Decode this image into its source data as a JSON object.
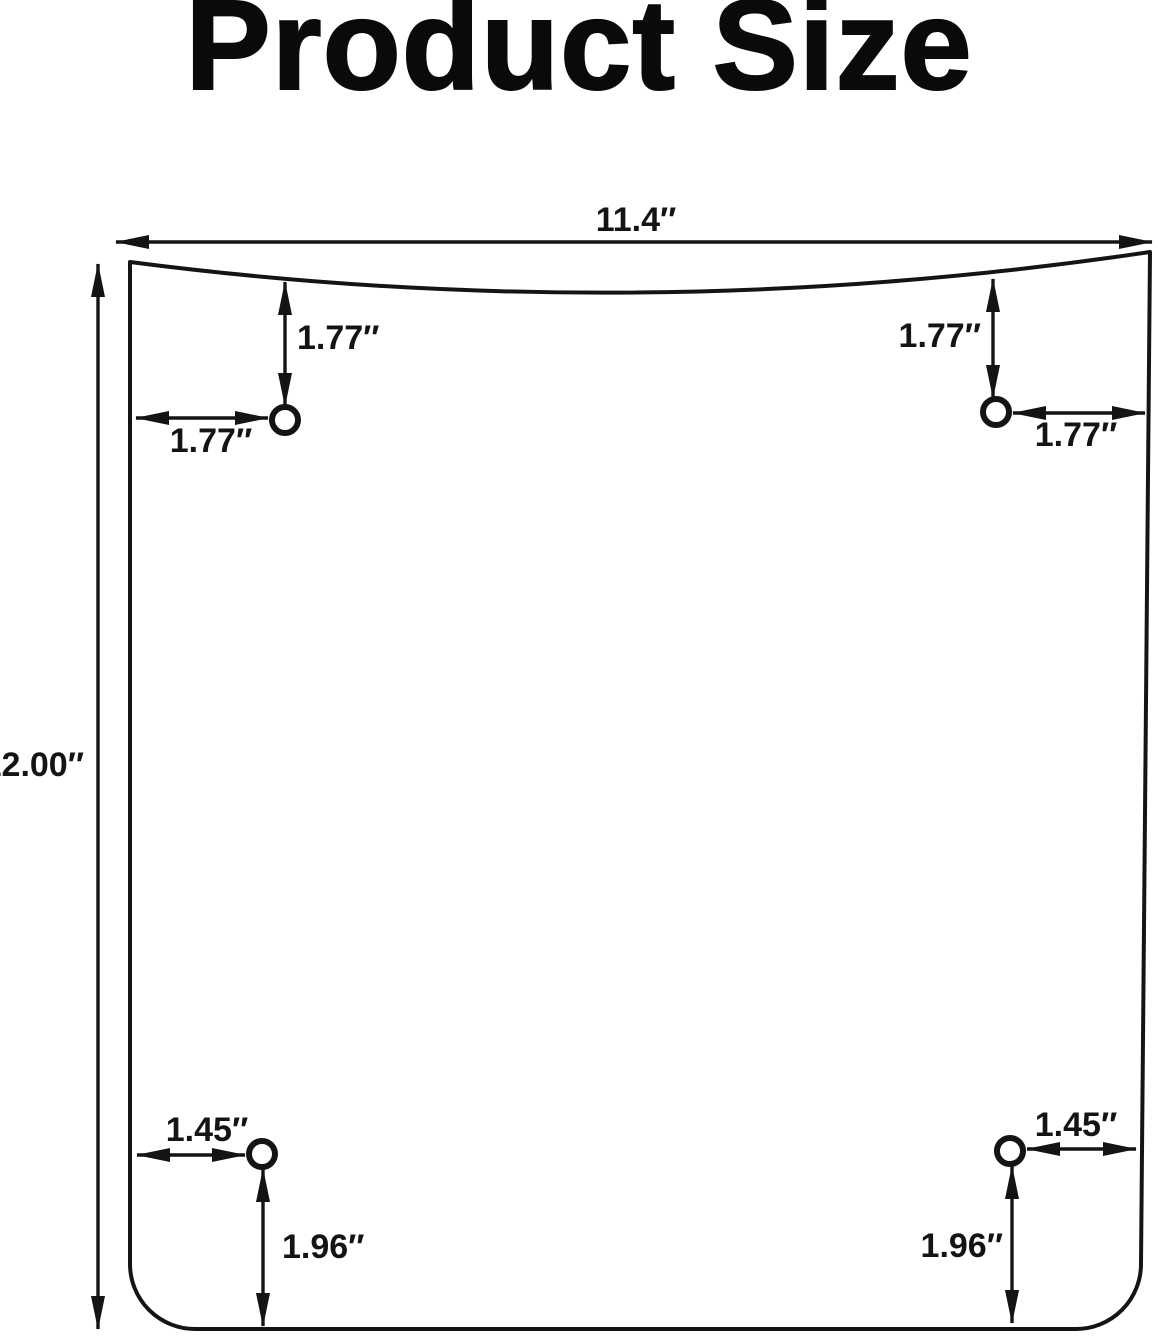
{
  "title": "Product Size",
  "colors": {
    "line": "#141414",
    "background": "#ffffff",
    "text": "#141414"
  },
  "dimensions": {
    "overall": {
      "width": "11.4″",
      "height": "12.00″"
    },
    "hole_top_left": {
      "from_top": "1.77″",
      "from_left": "1.77″"
    },
    "hole_top_right": {
      "from_top": "1.77″",
      "from_right": "1.77″"
    },
    "hole_bottom_left": {
      "from_left": "1.45″",
      "from_bottom": "1.96″"
    },
    "hole_bottom_right": {
      "from_right": "1.45″",
      "from_bottom": "1.96″"
    }
  }
}
